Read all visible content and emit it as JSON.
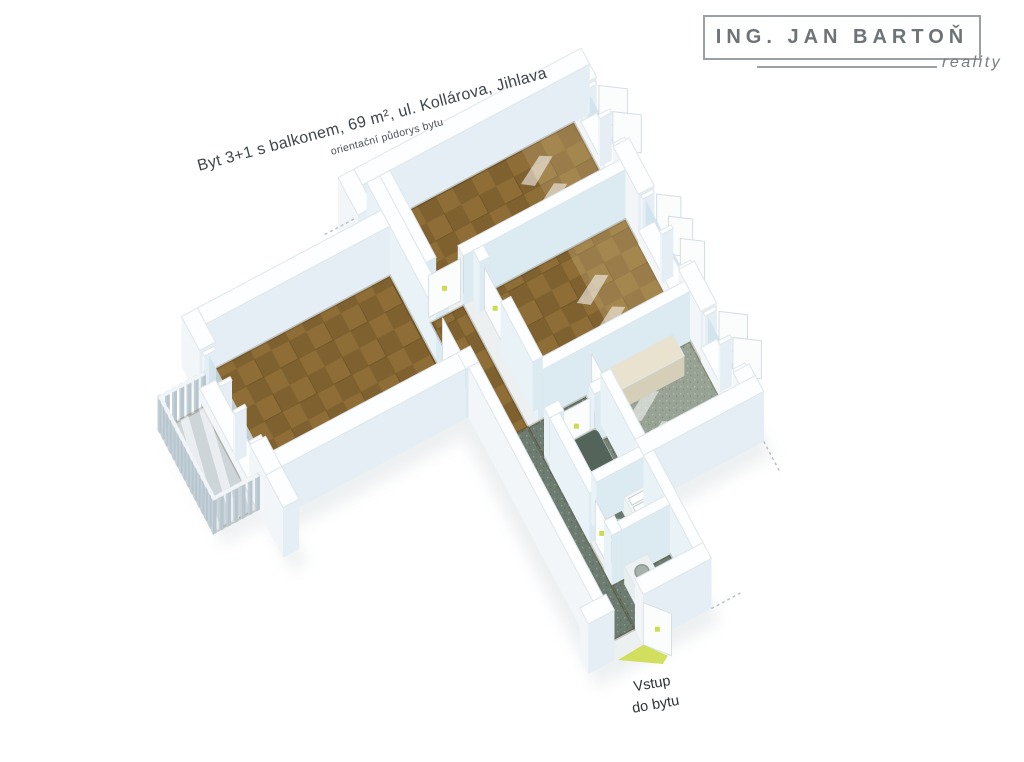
{
  "page": {
    "background": "#ffffff"
  },
  "branding": {
    "name": "ING. JAN BARTOŇ",
    "tagline": "reality",
    "text_color": "#6e7377",
    "box_border_color": "#9aa0a4"
  },
  "titles": {
    "main": "Byt 3+1 s balkonem, 69 m², ul. Kollárova, Jihlava",
    "sub": "orientační půdorys bytu",
    "color": "#3f4549"
  },
  "entry_label": {
    "line1": "Vstup",
    "line2": "do bytu",
    "color": "#2d3337"
  },
  "floorplan": {
    "origin": [
      400,
      215
    ],
    "scale": 0.82,
    "rot": -28,
    "wallH": 50,
    "railH": 34,
    "palette": {
      "wallTop": "#fdfeff",
      "wallEdge": "#e0e6ea",
      "extF": "#e4eef4",
      "extL": "#f3f6f8",
      "extR": "#eaf1f5",
      "intF": "#dcebf2",
      "intL": "#e8f2f7",
      "intR": "#cfdfe9",
      "parquetA": "#8e6d36",
      "parquetB": "#7f6130",
      "corridorFloor": "#6d7c70",
      "kitchenFloor": "#98a395",
      "bathFloor": "#76857a",
      "wcFloor": "#6f7e73",
      "balconyFloor": "#ced5d9",
      "stripe": "#ffffff",
      "glass": "#cfe2ec",
      "frame": "#ffffff",
      "marker": "#cddb4e",
      "shadow": "#dfe4e7",
      "tubRim": "#b6c2b9",
      "tubInner": "#55645b",
      "fixture": "#5f6e64",
      "counterBeigeTop": "#e8e2cf",
      "counterBeigeFace": "#d5cfba",
      "counterGrayTop": "#b2ac9c",
      "counterGrayFace": "#a19b8c",
      "applianceTop": "#eef1f2",
      "applianceFace": "#dfe5e7",
      "railSlat": "#b7c5ce",
      "railTop": "#f1f5f7",
      "patch": "rgba(255,255,255,0.55)",
      "glow": "rgba(246,222,168,0.22)",
      "floorEdge": "rgba(70,55,25,0.22)"
    },
    "floors": [
      {
        "name": "bedroom-1-floor",
        "rect": [
          -14,
          0,
          240,
          120
        ],
        "fill": "parquet",
        "glow": [
          168,
          0,
          240,
          120
        ]
      },
      {
        "name": "bedroom-2-floor",
        "rect": [
          44,
          134,
          240,
          288
        ],
        "fill": "parquet",
        "glow": [
          160,
          134,
          240,
          288
        ]
      },
      {
        "name": "kitchen-floor",
        "rect": [
          110,
          302,
          240,
          430
        ],
        "fill": "kitchen"
      },
      {
        "name": "living-room-floor",
        "rect": [
          -300,
          60,
          -46,
          235
        ],
        "fill": "parquet"
      },
      {
        "name": "hall-floor",
        "rect": [
          -28,
          134,
          16,
          302
        ],
        "fill": "parquet"
      },
      {
        "name": "corridor-floor",
        "rect": [
          -28,
          302,
          16,
          580
        ],
        "fill": "corridor"
      },
      {
        "name": "corridor-branch-floor",
        "rect": [
          16,
          302,
          96,
          344
        ],
        "fill": "corridor"
      },
      {
        "name": "bathroom-floor",
        "rect": [
          30,
          358,
          96,
          440
        ],
        "fill": "bath"
      },
      {
        "name": "wc-floor",
        "rect": [
          30,
          454,
          96,
          508
        ],
        "fill": "wc"
      },
      {
        "name": "vestibule-floor",
        "rect": [
          16,
          520,
          96,
          580
        ],
        "fill": "corridor"
      },
      {
        "name": "balcony-floor",
        "rect": [
          -382,
          95,
          -322,
          235
        ],
        "fill": "balcony"
      }
    ],
    "walls": [
      {
        "r": [
          -52,
          -22,
          262,
          0
        ],
        "ext": 1
      },
      {
        "r": [
          240,
          0,
          262,
          18
        ],
        "ext": 1
      },
      {
        "r": [
          240,
          102,
          262,
          168
        ],
        "ext": 1
      },
      {
        "r": [
          240,
          272,
          262,
          330
        ],
        "ext": 1
      },
      {
        "r": [
          240,
          414,
          262,
          452
        ],
        "ext": 1
      },
      {
        "r": [
          240,
          18,
          262,
          102
        ],
        "ext": 1,
        "h": 14
      },
      {
        "r": [
          240,
          168,
          262,
          272
        ],
        "ext": 1,
        "h": 14
      },
      {
        "r": [
          240,
          330,
          262,
          414
        ],
        "ext": 1,
        "h": 14
      },
      {
        "r": [
          16,
          120,
          240,
          134
        ]
      },
      {
        "r": [
          30,
          134,
          44,
          150
        ]
      },
      {
        "r": [
          30,
          205,
          44,
          288
        ]
      },
      {
        "r": [
          30,
          288,
          240,
          302
        ]
      },
      {
        "r": [
          96,
          340,
          110,
          430
        ]
      },
      {
        "r": [
          96,
          430,
          262,
          452
        ],
        "ext": 1
      },
      {
        "r": [
          16,
          344,
          36,
          358
        ]
      },
      {
        "r": [
          78,
          344,
          96,
          358
        ]
      },
      {
        "r": [
          16,
          358,
          30,
          462
        ]
      },
      {
        "r": [
          16,
          500,
          30,
          520
        ]
      },
      {
        "r": [
          30,
          440,
          96,
          454
        ]
      },
      {
        "r": [
          30,
          508,
          96,
          520
        ]
      },
      {
        "r": [
          96,
          452,
          110,
          580
        ]
      },
      {
        "r": [
          -60,
          580,
          -24,
          602
        ],
        "ext": 1
      },
      {
        "r": [
          16,
          580,
          110,
          602
        ],
        "ext": 1
      },
      {
        "r": [
          -46,
          0,
          -28,
          180
        ]
      },
      {
        "r": [
          -46,
          235,
          -28,
          257
        ]
      },
      {
        "r": [
          -28,
          0,
          -14,
          120
        ]
      },
      {
        "r": [
          -322,
          38,
          -300,
          85
        ],
        "ext": 1
      },
      {
        "r": [
          -322,
          215,
          -300,
          257
        ],
        "ext": 1
      },
      {
        "r": [
          -322,
          85,
          -300,
          215
        ],
        "ext": 1,
        "h": 12
      },
      {
        "r": [
          -300,
          38,
          -46,
          60
        ],
        "ext": 1
      },
      {
        "r": [
          -322,
          235,
          -46,
          257
        ],
        "ext": 1
      },
      {
        "r": [
          -74,
          -22,
          -52,
          30
        ],
        "ext": 1
      },
      {
        "r": [
          -322,
          257,
          -300,
          302
        ],
        "ext": 1
      },
      {
        "r": [
          -42,
          257,
          -28,
          580
        ],
        "ext": 1
      }
    ],
    "windows": [
      {
        "name": "bedroom-1-window",
        "v1": 18,
        "v2": 102,
        "sashes": 2
      },
      {
        "name": "bedroom-2-window",
        "v1": 168,
        "v2": 272,
        "sashes": 3
      },
      {
        "name": "kitchen-window",
        "v1": 330,
        "v2": 414,
        "sashes": 2
      }
    ],
    "gable_glazing": {
      "v1": 85,
      "v2": 215
    },
    "doors": [
      {
        "name": "living-room-door",
        "a": [
          -37,
          180
        ],
        "b": [
          -37,
          235
        ]
      },
      {
        "name": "bedroom-1-door",
        "a": [
          -28,
          127
        ],
        "b": [
          16,
          127
        ]
      },
      {
        "name": "bedroom-2-door",
        "a": [
          37,
          150
        ],
        "b": [
          37,
          205
        ]
      },
      {
        "name": "kitchen-door",
        "a": [
          103,
          304
        ],
        "b": [
          103,
          338
        ]
      },
      {
        "name": "bathroom-door",
        "a": [
          38,
          351
        ],
        "b": [
          76,
          351
        ]
      },
      {
        "name": "wc-door",
        "a": [
          23,
          464
        ],
        "b": [
          23,
          498
        ]
      },
      {
        "name": "entry-door",
        "a": [
          16,
          602
        ],
        "b": [
          40,
          630
        ],
        "entry": 1
      }
    ],
    "furniture": {
      "bathtub": {
        "rect": [
          34,
          362,
          78,
          436
        ],
        "inner": [
          40,
          370,
          72,
          428
        ],
        "h": 20
      },
      "toilet": {
        "rect": [
          34,
          460,
          62,
          490
        ],
        "h": 14
      },
      "shelf": {
        "rect": [
          66,
          458,
          96,
          506
        ],
        "h": 24,
        "squares": 4
      },
      "washer": {
        "rect": [
          30,
          526,
          62,
          558
        ],
        "h": 18
      },
      "counter_beige": {
        "rect": [
          116,
          306,
          214,
          336
        ],
        "h": 20
      },
      "counter_gray": {
        "rect": [
          184,
          398,
          238,
          426
        ],
        "h": 18
      }
    },
    "railing_edges": [
      [
        [
          -382,
          95
        ],
        [
          -382,
          235
        ]
      ],
      [
        [
          -382,
          95
        ],
        [
          -322,
          95
        ]
      ],
      [
        [
          -382,
          235
        ],
        [
          -322,
          235
        ]
      ]
    ],
    "patches": [
      {
        "room": 0,
        "at": [
          148,
          36
        ]
      },
      {
        "room": 0,
        "at": [
          148,
          74
        ]
      },
      {
        "room": 1,
        "at": [
          140,
          196
        ]
      },
      {
        "room": 1,
        "at": [
          140,
          240
        ]
      },
      {
        "room": 2,
        "at": [
          128,
          350
        ]
      },
      {
        "room": 2,
        "at": [
          128,
          392
        ]
      }
    ],
    "footprint": [
      [
        -74,
        -22
      ],
      [
        262,
        -22
      ],
      [
        262,
        452
      ],
      [
        110,
        452
      ],
      [
        110,
        602
      ],
      [
        -60,
        602
      ],
      [
        -60,
        257
      ],
      [
        -300,
        257
      ],
      [
        -300,
        302
      ],
      [
        -322,
        302
      ],
      [
        -322,
        38
      ],
      [
        -52,
        38
      ],
      [
        -52,
        -22
      ]
    ],
    "cut_lines": [
      [
        [
          262,
          452
        ],
        [
          262,
          496
        ]
      ],
      [
        [
          -52,
          -22
        ],
        [
          -96,
          -22
        ]
      ],
      [
        [
          110,
          602
        ],
        [
          152,
          602
        ]
      ]
    ]
  }
}
